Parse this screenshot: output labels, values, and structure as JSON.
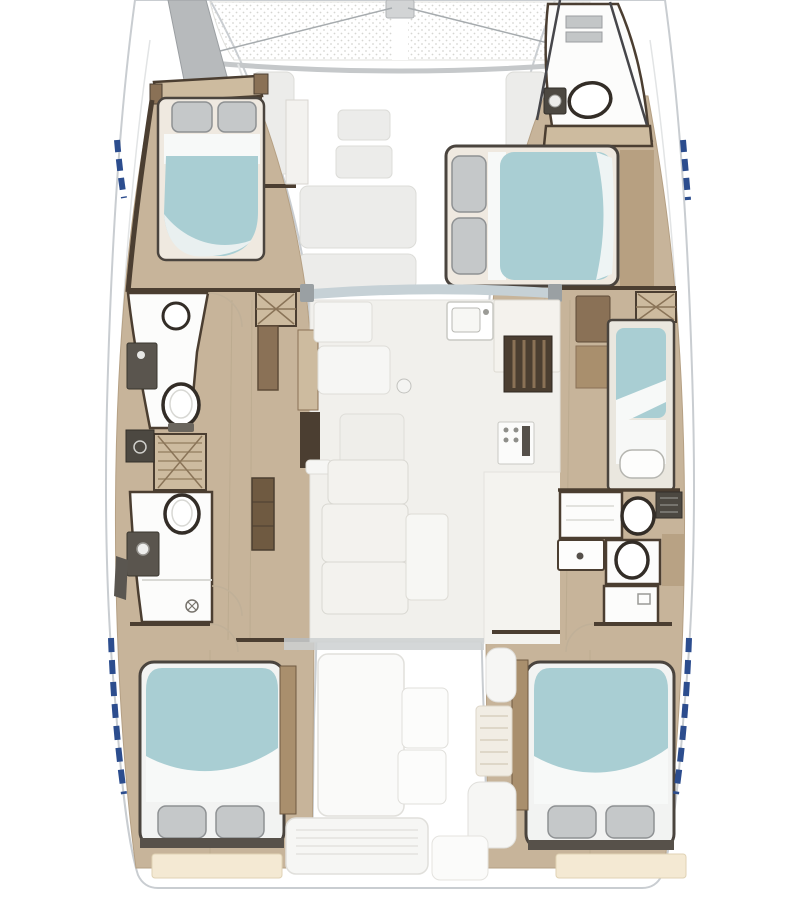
{
  "diagram": {
    "kind": "catamaran yacht floor plan",
    "view": "top-down accommodation layout",
    "orientation": "bow at top, stern at bottom"
  },
  "colors": {
    "background": "#ffffff",
    "hull_line": "#c9cdd1",
    "deck_line": "#e2e4e5",
    "tramp_dot": "#d6d6d2",
    "wood_floor": "#c7b49a",
    "wood_trim": "#8a7156",
    "wood_dark": "#a98f6d",
    "bulkhead": "#4b3e31",
    "mattress": "#a9ced3",
    "sheet": "#f7f9f8",
    "pillow": "#c5c8c9",
    "pillow_line": "#8e9193",
    "fixture_white": "#fcfcfb",
    "fixture_dark": "#4c4841",
    "fixture_line": "#332d27",
    "salon_floor": "#f1f0ec",
    "furniture_fill": "#f6f6f4",
    "furniture_line": "#deddd8",
    "steps_fill": "#cdbb9f",
    "steps_line": "#9c8869",
    "windshield": "#c6d1d6",
    "divider": "#cdd0d1",
    "accent_blue": "#2c4d8e",
    "transom_beige": "#f4e9d3",
    "bow_deck_gray": "#b7babc"
  },
  "inventory": {
    "cabins": [
      {
        "name": "port-forward-cabin",
        "berth": "double",
        "pillows": 2
      },
      {
        "name": "starboard-forward-cabin",
        "berth": "double",
        "pillows": 2
      },
      {
        "name": "starboard-single-berth",
        "berth": "single",
        "pillows": 1
      },
      {
        "name": "port-aft-cabin",
        "berth": "double",
        "pillows": 2
      },
      {
        "name": "starboard-aft-cabin",
        "berth": "double",
        "pillows": 2
      }
    ],
    "heads": [
      {
        "name": "starboard-bow-head",
        "fixtures": [
          "toilet",
          "sink"
        ]
      },
      {
        "name": "port-forward-head",
        "fixtures": [
          "toilet",
          "sink",
          "vanity"
        ]
      },
      {
        "name": "port-aft-head",
        "fixtures": [
          "toilet",
          "sink",
          "shower"
        ]
      },
      {
        "name": "starboard-aft-head",
        "fixtures": [
          "toilet",
          "toilet",
          "sink",
          "shower"
        ]
      }
    ],
    "salon": [
      "galley-sink",
      "galley-counter",
      "slatted-locker",
      "stove",
      "settee",
      "coffee-table",
      "nav-seating",
      "mast-post"
    ],
    "deck": [
      "trampoline",
      "anchor-roller",
      "bridle-lines",
      "foredeck-hatches",
      "windshield",
      "cockpit-settee",
      "cockpit-tables",
      "cockpit-bench",
      "helm-steps",
      "transom-steps"
    ],
    "stairs": [
      "port-companionway",
      "starboard-companionway",
      "port-mid-steps"
    ]
  }
}
